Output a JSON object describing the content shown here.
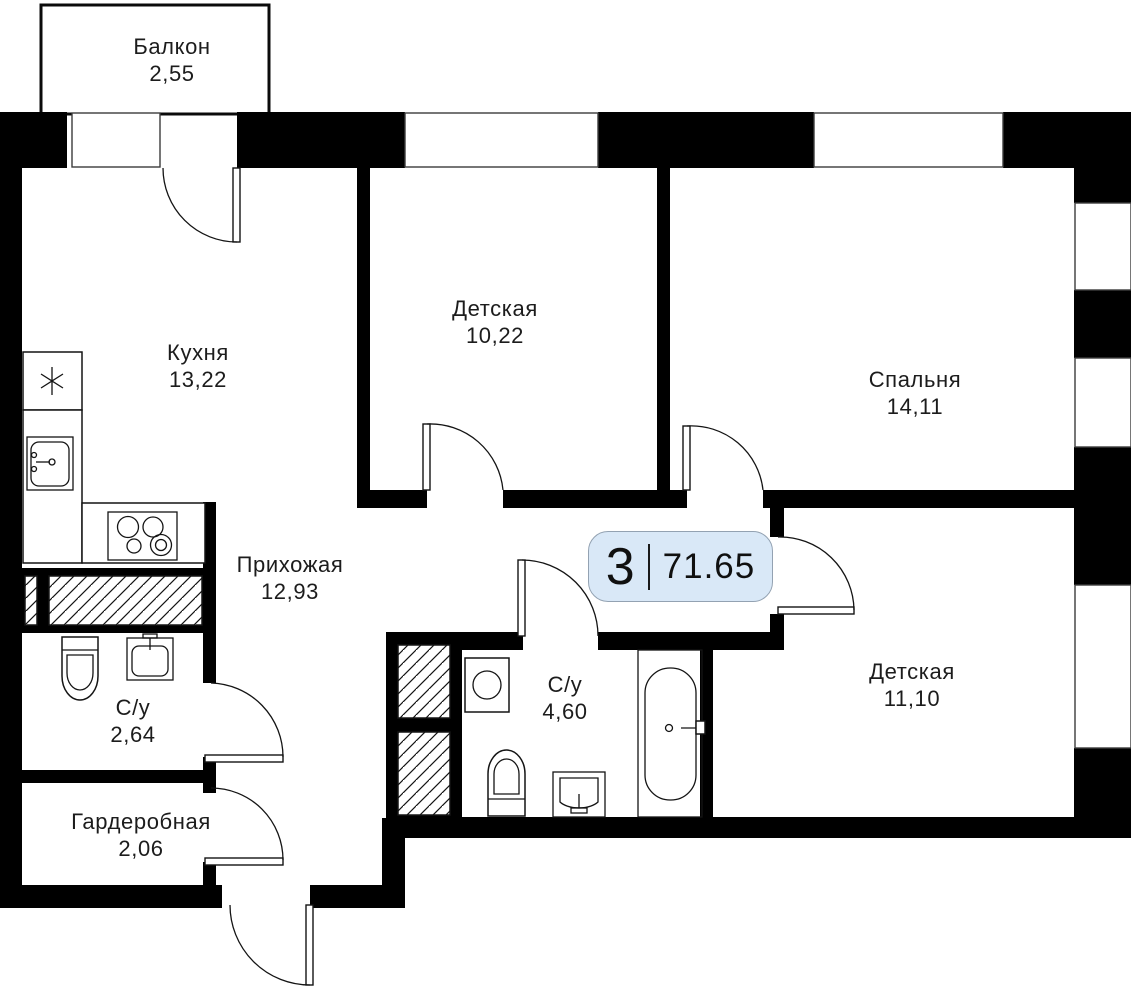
{
  "plan": {
    "title": "Floor plan of 3-room apartment",
    "badge": {
      "rooms": "3",
      "area": "71.65"
    },
    "rooms": [
      {
        "id": "balcony",
        "name": "Балкон",
        "area": "2,55"
      },
      {
        "id": "kitchen",
        "name": "Кухня",
        "area": "13,22"
      },
      {
        "id": "nursery1",
        "name": "Детская",
        "area": "10,22"
      },
      {
        "id": "bedroom",
        "name": "Спальня",
        "area": "14,11"
      },
      {
        "id": "hallway",
        "name": "Прихожая",
        "area": "12,93"
      },
      {
        "id": "bathroom1",
        "name": "С/у",
        "area": "2,64"
      },
      {
        "id": "wardrobe",
        "name": "Гардеробная",
        "area": "2,06"
      },
      {
        "id": "bathroom2",
        "name": "С/у",
        "area": "4,60"
      },
      {
        "id": "nursery2",
        "name": "Детская",
        "area": "11,10"
      }
    ],
    "colors": {
      "wall": "#000000",
      "badge_fill": "#d9e8f7",
      "badge_border": "#93a2b2",
      "text": "#1c1c1c"
    }
  }
}
